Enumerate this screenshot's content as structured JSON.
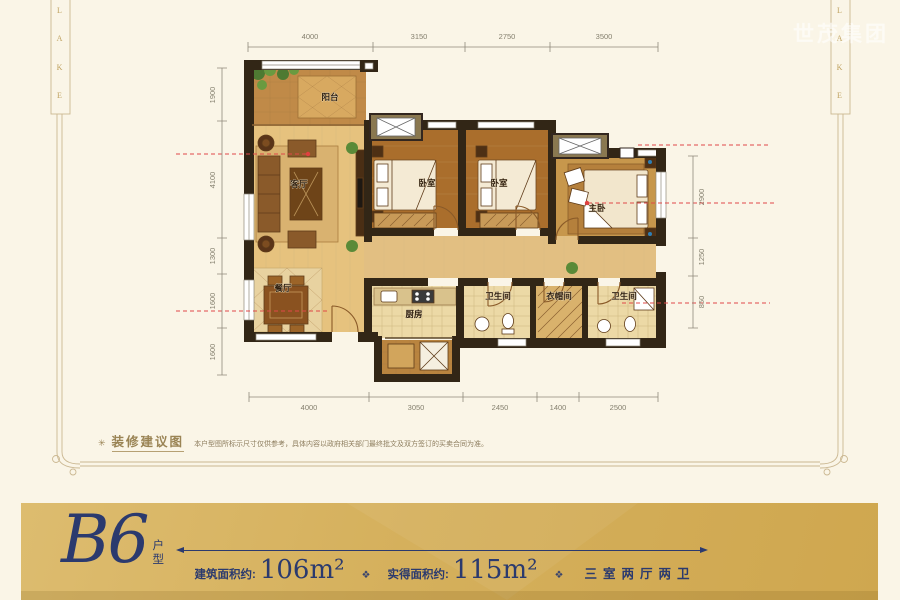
{
  "frame": {
    "lake_letters": [
      "L",
      "A",
      "K",
      "E"
    ]
  },
  "watermark": {
    "text": "世茂集团"
  },
  "note": {
    "marker": "✳",
    "title": "装修建议图",
    "body": "本户型图所标示尺寸仅供参考，具体内容以政府相关部门最终批文及双方签订的买卖合同为准。"
  },
  "plan": {
    "dimensions": {
      "top": [
        "4000",
        "3150",
        "2750",
        "3500"
      ],
      "bottom": [
        "4000",
        "3050",
        "2450",
        "1400",
        "2500"
      ],
      "left": [
        "1900",
        "4100",
        "1300",
        "1600",
        "1600"
      ],
      "right": [
        "2900",
        "1250",
        "850"
      ]
    },
    "rooms": [
      {
        "id": "balcony",
        "label": "阳台"
      },
      {
        "id": "living-room",
        "label": "客厅"
      },
      {
        "id": "dining-room",
        "label": "餐厅"
      },
      {
        "id": "kitchen",
        "label": "厨房"
      },
      {
        "id": "bath-1",
        "label": "卫生间"
      },
      {
        "id": "cloakroom",
        "label": "衣帽间"
      },
      {
        "id": "bath-2",
        "label": "卫生间"
      },
      {
        "id": "bedroom-1",
        "label": "卧室"
      },
      {
        "id": "bedroom-2",
        "label": "卧室"
      },
      {
        "id": "master-bedroom",
        "label": "主卧"
      }
    ]
  },
  "banner": {
    "unit_code": "B6",
    "unit_suffix_top": "户",
    "unit_suffix_bottom": "型",
    "ornament": "❖",
    "metrics": [
      {
        "label": "建筑面积约:",
        "value": "106m²"
      },
      {
        "label": "实得面积约:",
        "value": "115m²"
      }
    ],
    "layout_text": "三室两厅两卫"
  },
  "colors": {
    "banner_bg": "#d5b05c",
    "navy": "#2b3a6e",
    "sightline_red": "#e04848",
    "frame_gold": "#cbb892",
    "wall": "#322616"
  }
}
